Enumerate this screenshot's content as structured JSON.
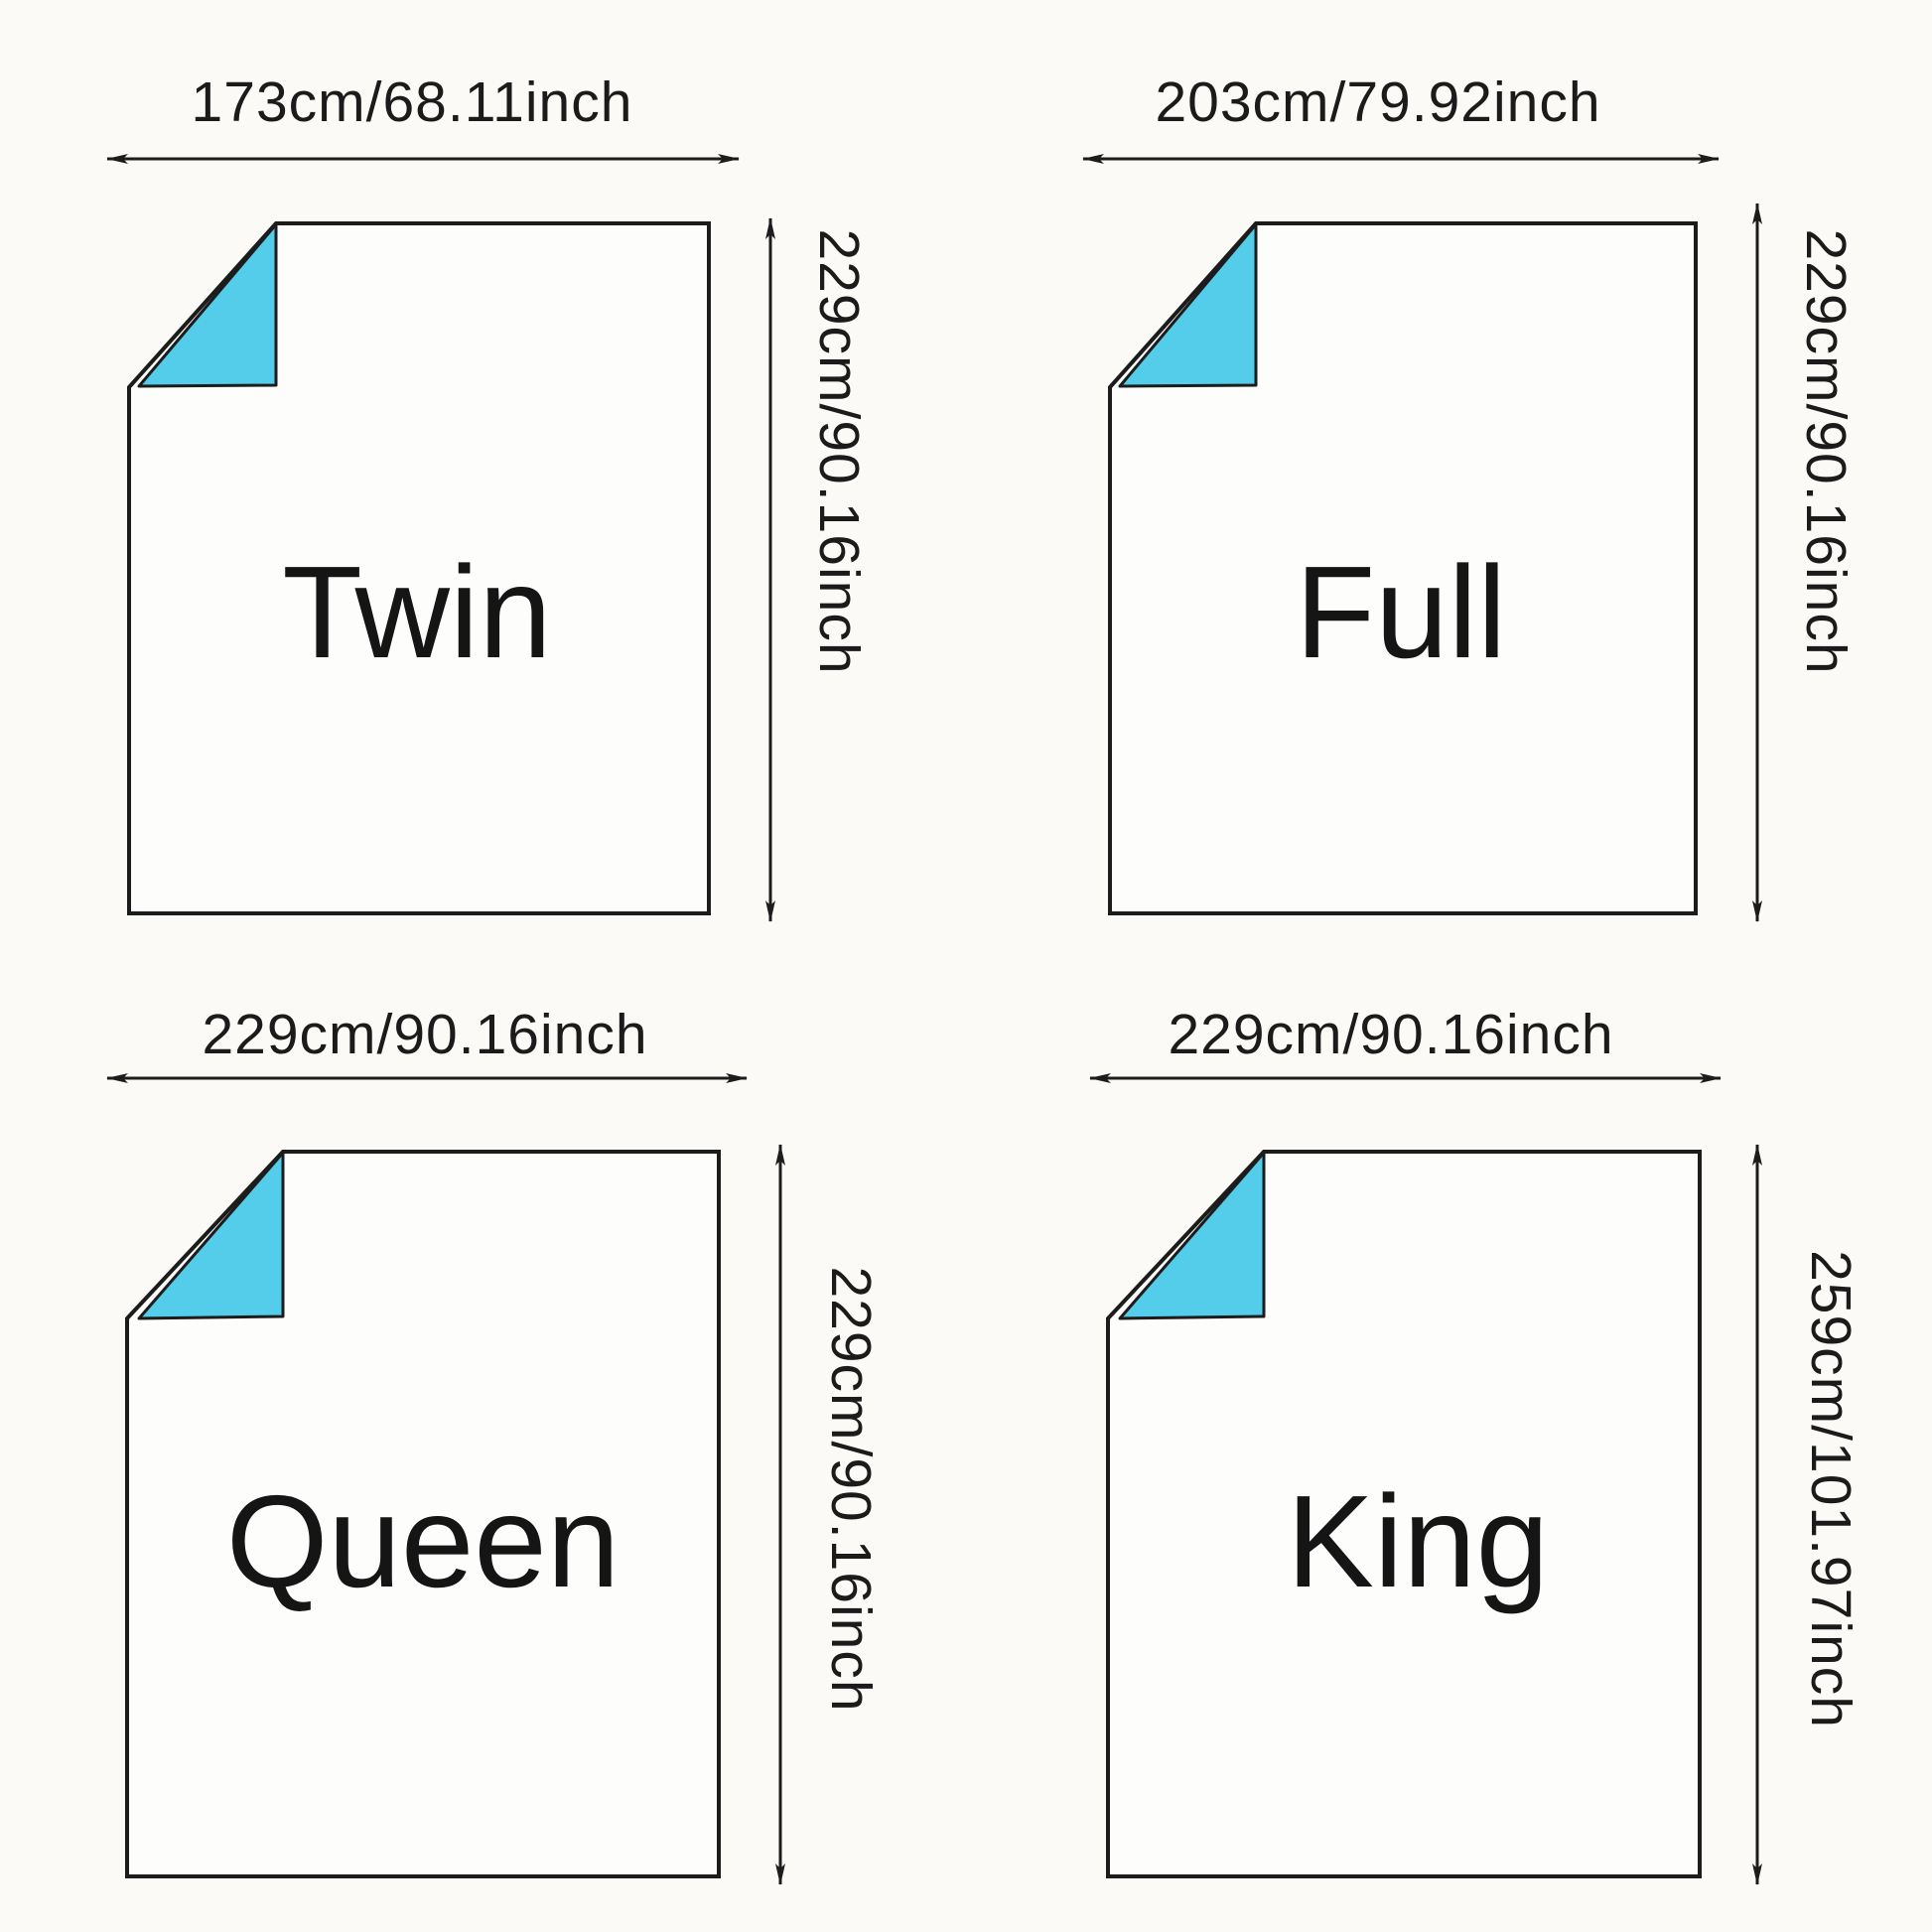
{
  "diagram": {
    "title": "Duvet size chart",
    "panels": [
      {
        "size_label": "Twin",
        "width_label": "173cm/68.11inch",
        "height_label": "229cm/90.16inch"
      },
      {
        "size_label": "Full",
        "width_label": "203cm/79.92inch",
        "height_label": "229cm/90.16inch"
      },
      {
        "size_label": "Queen",
        "width_label": "229cm/90.16inch",
        "height_label": "229cm/90.16inch"
      },
      {
        "size_label": "King",
        "width_label": "229cm/90.16inch",
        "height_label": "259cm/101.97inch"
      }
    ],
    "colors": {
      "fold_accent": "#53cdea",
      "line": "#1c1c1c",
      "background": "#fbfaf7",
      "sheet_fill": "#fdfdfb"
    }
  }
}
